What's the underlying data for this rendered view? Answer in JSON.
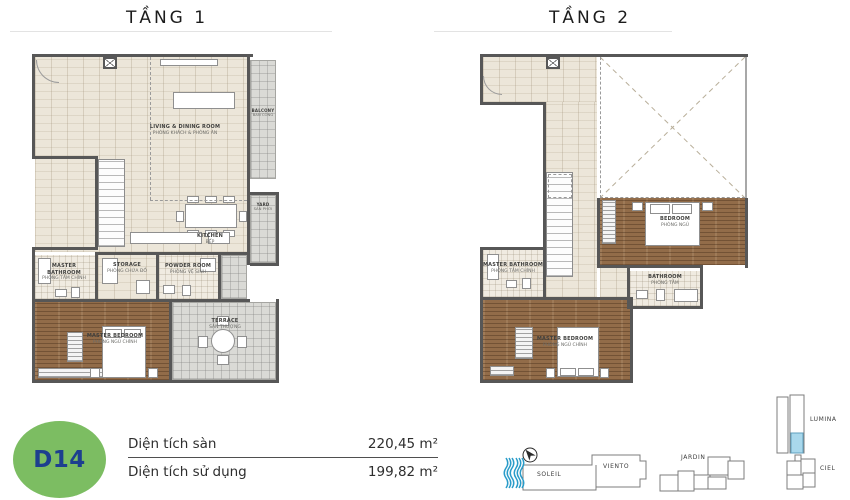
{
  "floors": {
    "floor1": {
      "title": "TẦNG 1",
      "rooms": {
        "living": {
          "name": "LIVING & DINING ROOM",
          "sub": "PHÒNG KHÁCH & PHÒNG ĂN"
        },
        "balcony": {
          "name": "BALCONY",
          "sub": "BAN CÔNG"
        },
        "kitchen": {
          "name": "KITCHEN",
          "sub": "BẾP"
        },
        "yard": {
          "name": "YARD",
          "sub": "SÂN PHƠI"
        },
        "master_bathroom": {
          "name": "MASTER BATHROOM",
          "sub": "PHÒNG TẮM CHÍNH"
        },
        "storage": {
          "name": "STORAGE",
          "sub": "PHÒNG CHỨA ĐỒ"
        },
        "powder": {
          "name": "POWDER ROOM",
          "sub": "PHÒNG VỆ SINH"
        },
        "master_bedroom": {
          "name": "MASTER BEDROOM",
          "sub": "PHÒNG NGỦ CHÍNH"
        },
        "terrace": {
          "name": "TERRACE",
          "sub": "SÂN THƯỢNG"
        }
      }
    },
    "floor2": {
      "title": "TẦNG 2",
      "rooms": {
        "bedroom": {
          "name": "BEDROOM",
          "sub": "PHÒNG NGỦ"
        },
        "master_bathroom": {
          "name": "MASTER BATHROOM",
          "sub": "PHÒNG TẮM CHÍNH"
        },
        "bathroom": {
          "name": "BATHROOM",
          "sub": "PHÒNG TẮM"
        },
        "master_bedroom": {
          "name": "MASTER BEDROOM",
          "sub": "PHÒNG NGỦ CHÍNH"
        }
      }
    }
  },
  "unit": {
    "code": "D14",
    "badge_color": "#7cbd62",
    "code_color": "#1d3f8f"
  },
  "areas": {
    "floor_area": {
      "label": "Diện tích sàn",
      "value": "220,45 m²"
    },
    "usable_area": {
      "label": "Diện tích sử dụng",
      "value": "199,82 m²"
    }
  },
  "site_plan": {
    "buildings": {
      "soleil": "SOLEIL",
      "viento": "VIENTO",
      "jardin": "JARDIN",
      "lumina": "LUMINA",
      "ciel": "CIEL"
    },
    "highlight_color": "#a9d8ec",
    "water_color": "#2a9cc9"
  },
  "colors": {
    "wall": "#575757",
    "wood_floor": "#926c49",
    "indoor_floor": "#ece6d9",
    "outdoor_floor": "#dadad6"
  }
}
